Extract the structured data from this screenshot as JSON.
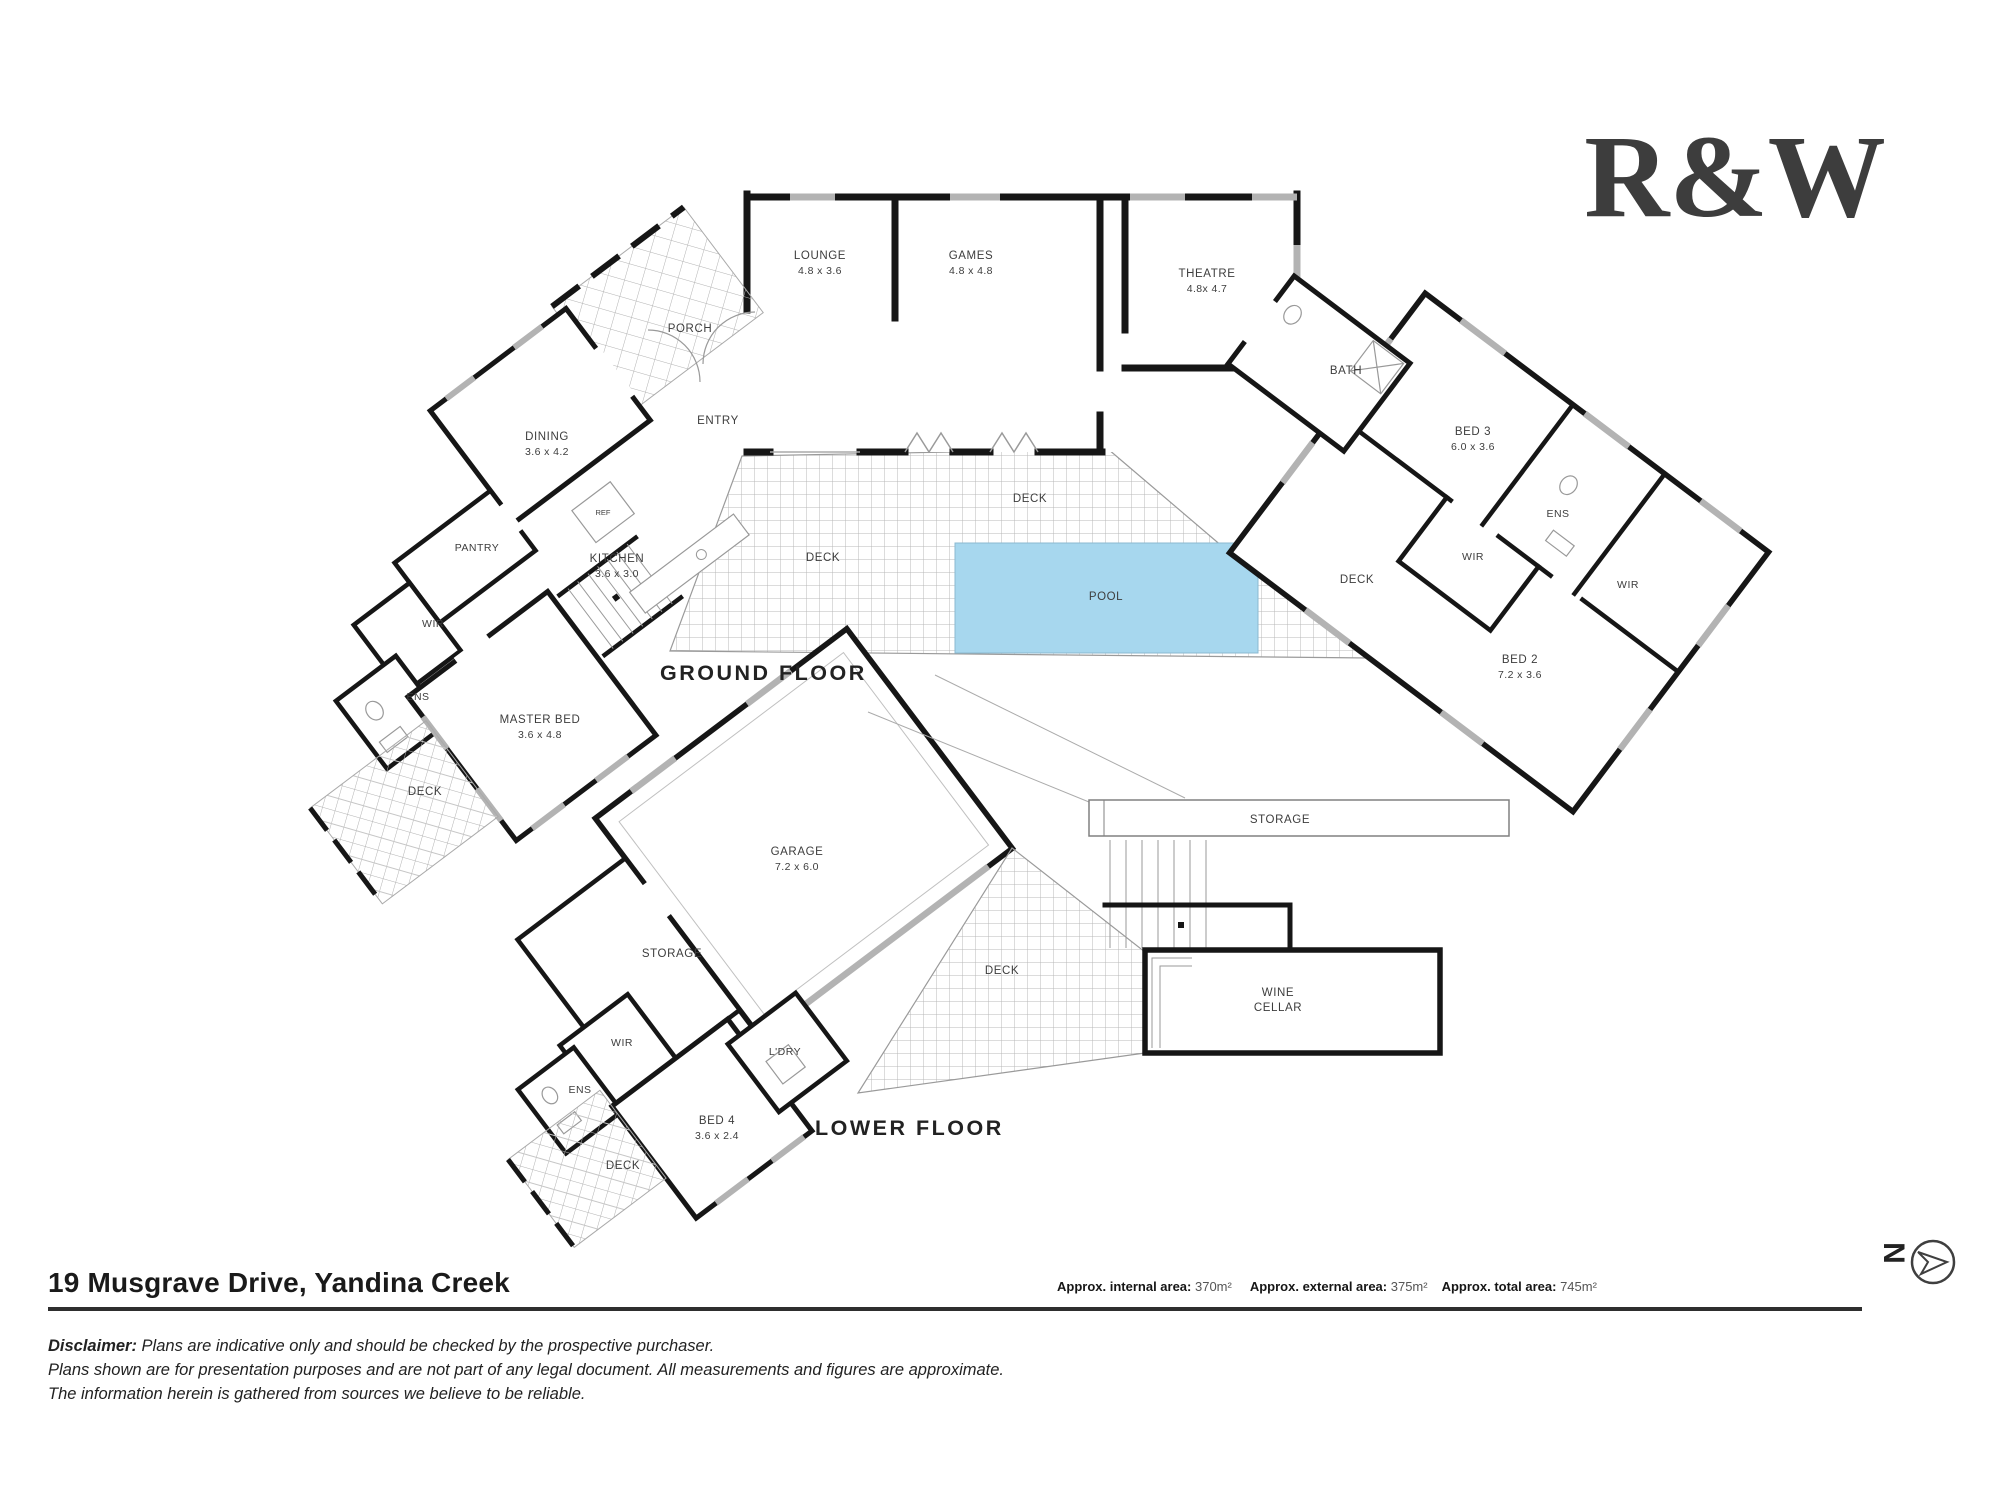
{
  "brand": {
    "logo_text": "R&W",
    "logo_color": "#e31e2d"
  },
  "title": {
    "address": "19 Musgrave Drive, Yandina Creek"
  },
  "areas": {
    "internal_label": "Approx. internal area: ",
    "internal_value": "370m²",
    "external_label": "Approx.  external area: ",
    "external_value": "375m²",
    "total_label": "Approx. total area: ",
    "total_value": "745m²"
  },
  "disclaimer": {
    "label": "Disclaimer:",
    "line1": " Plans are indicative only and should be checked by the prospective purchaser.",
    "line2": "Plans shown are for presentation purposes and are not part of any legal document. All measurements and figures are approximate.",
    "line3": "The information herein is gathered from sources we believe to be reliable."
  },
  "compass": {
    "letter": "N"
  },
  "plan": {
    "ground_floor_label": "GROUND FLOOR",
    "lower_floor_label": "LOWER FLOOR",
    "colors": {
      "pool_fill": "#a7d7ee",
      "wall": "#161616",
      "window": "#b3b3b3"
    },
    "rooms": {
      "lounge": {
        "name": "LOUNGE",
        "dims": "4.8 x 3.6"
      },
      "games": {
        "name": "GAMES",
        "dims": "4.8 x 4.8"
      },
      "theatre": {
        "name": "THEATRE",
        "dims": "4.8x 4.7"
      },
      "dining": {
        "name": "DINING",
        "dims": "3.6 x 4.2"
      },
      "kitchen": {
        "name": "KITCHEN",
        "dims": "3.6 x 3.0"
      },
      "master": {
        "name": "MASTER BED",
        "dims": "3.6 x 4.8"
      },
      "bed2": {
        "name": "BED 2",
        "dims": "7.2 x 3.6"
      },
      "bed3": {
        "name": "BED 3",
        "dims": "6.0 x 3.6"
      },
      "bed4": {
        "name": "BED 4",
        "dims": "3.6 x 2.4"
      },
      "garage": {
        "name": "GARAGE",
        "dims": "7.2 x 6.0"
      }
    },
    "labels": {
      "porch": "PORCH",
      "entry": "ENTRY",
      "pantry": "PANTRY",
      "ref": "REF",
      "wir": "WIR",
      "ens": "ENS",
      "bath": "BATH",
      "deck": "DECK",
      "pool": "POOL",
      "storage": "STORAGE",
      "ldry": "L'DRY",
      "wine_line1": "WINE",
      "wine_line2": "CELLAR"
    }
  }
}
